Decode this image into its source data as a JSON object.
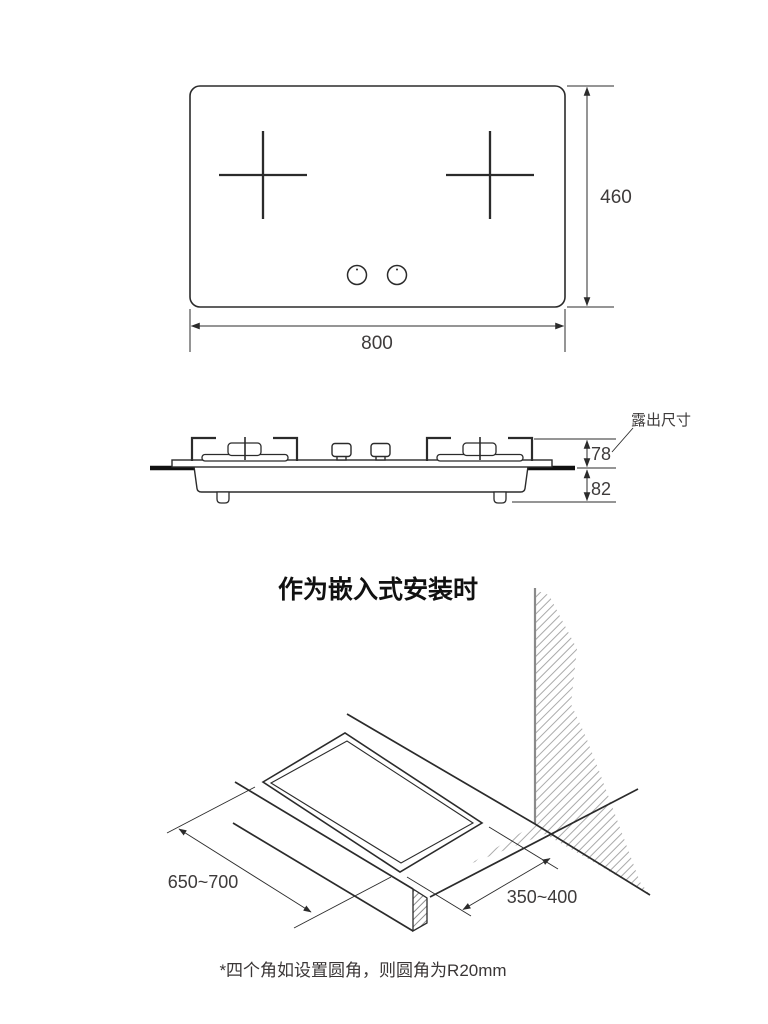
{
  "page": {
    "background": "#ffffff",
    "line_color": "#2b2b2b",
    "thick_line_color": "#111111",
    "hatch_color": "#aaaaaa",
    "text_color": "#3e3b3b"
  },
  "top_view": {
    "width_label": "800",
    "height_label": "460"
  },
  "side_view": {
    "exposed_dim_label": "露出尺寸",
    "above_counter_label": "78",
    "below_counter_label": "82"
  },
  "installation": {
    "title": "作为嵌入式安装时",
    "cutout_length_label": "650~700",
    "cutout_depth_label": "350~400"
  },
  "footnote_label": "*四个角如设置圆角，则圆角为R20mm"
}
